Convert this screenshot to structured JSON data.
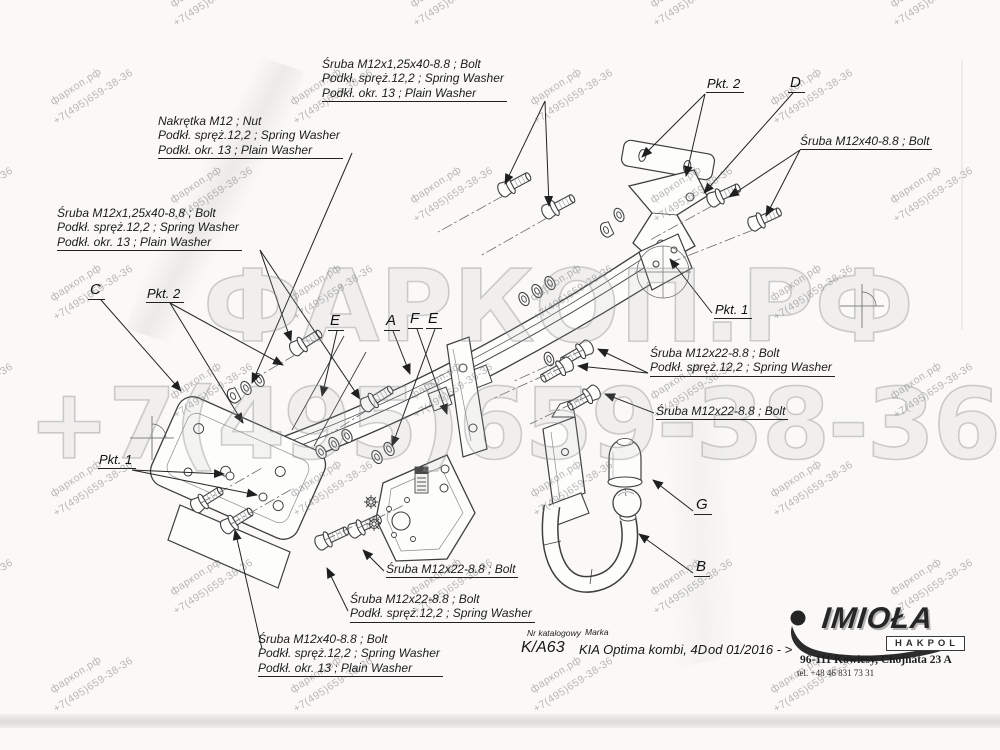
{
  "watermark": {
    "tile_line1": "фаркоп.рф",
    "tile_line2": "+7(495)659-38-36",
    "big_line1": "ФАРКОП.РФ",
    "big_line2": "+7(495)659-38-36"
  },
  "callouts": [
    {
      "lines": [
        "Śruba M12x1,25x40-8.8 ;  Bolt",
        "Podkł. spręż.12,2 ; Spring Washer",
        "Podkł. okr. 13 ; Plain Washer"
      ]
    },
    {
      "lines": [
        "Nakrętka  M12 ; Nut",
        "Podkł. spręż.12,2 ; Spring Washer",
        "Podkł. okr. 13 ; Plain Washer"
      ]
    },
    {
      "lines": [
        "Śruba M12x1,25x40-8.8 ;  Bolt",
        "Podkł. spręż.12,2 ; Spring Washer",
        "Podkł. okr. 13 ; Plain Washer"
      ]
    },
    {
      "lines": [
        "Śruba M12x40-8.8 ;  Bolt"
      ]
    },
    {
      "lines": [
        "Śruba M12x22-8.8 ;  Bolt",
        "Podkł. spręż.12,2 ; Spring Washer"
      ]
    },
    {
      "lines": [
        "Śruba M12x22-8.8 ;  Bolt"
      ]
    },
    {
      "lines": [
        "Śruba M12x22-8.8 ;  Bolt"
      ]
    },
    {
      "lines": [
        "Śruba M12x22-8.8 ;  Bolt",
        "Podkł. spręż.12,2 ; Spring Washer"
      ]
    },
    {
      "lines": [
        "Śruba M12x40-8.8 ;  Bolt",
        "Podkł. spręż.12,2 ; Spring Washer",
        "Podkł. okr. 13 ; Plain Washer"
      ]
    }
  ],
  "part_letters": {
    "a": "A",
    "b": "B",
    "c": "C",
    "d": "D",
    "e": "E",
    "f": "F",
    "g": "G"
  },
  "point_labels": {
    "pkt1": "Pkt. 1",
    "pkt2": "Pkt. 2"
  },
  "footer": {
    "catalog_label": "Nr katalogowy",
    "catalog_value": "K/A63",
    "brand_label": "Marka",
    "brand_value": "KIA Optima kombi, 4D",
    "availability": "od 01/2016 - >",
    "logo_title": "IMIOŁA",
    "logo_subtitle": "HAKPOL",
    "address": "96-111 Kowiesy, Chojnata 23 A",
    "phone": "tel. +48 46 831 73 31"
  }
}
